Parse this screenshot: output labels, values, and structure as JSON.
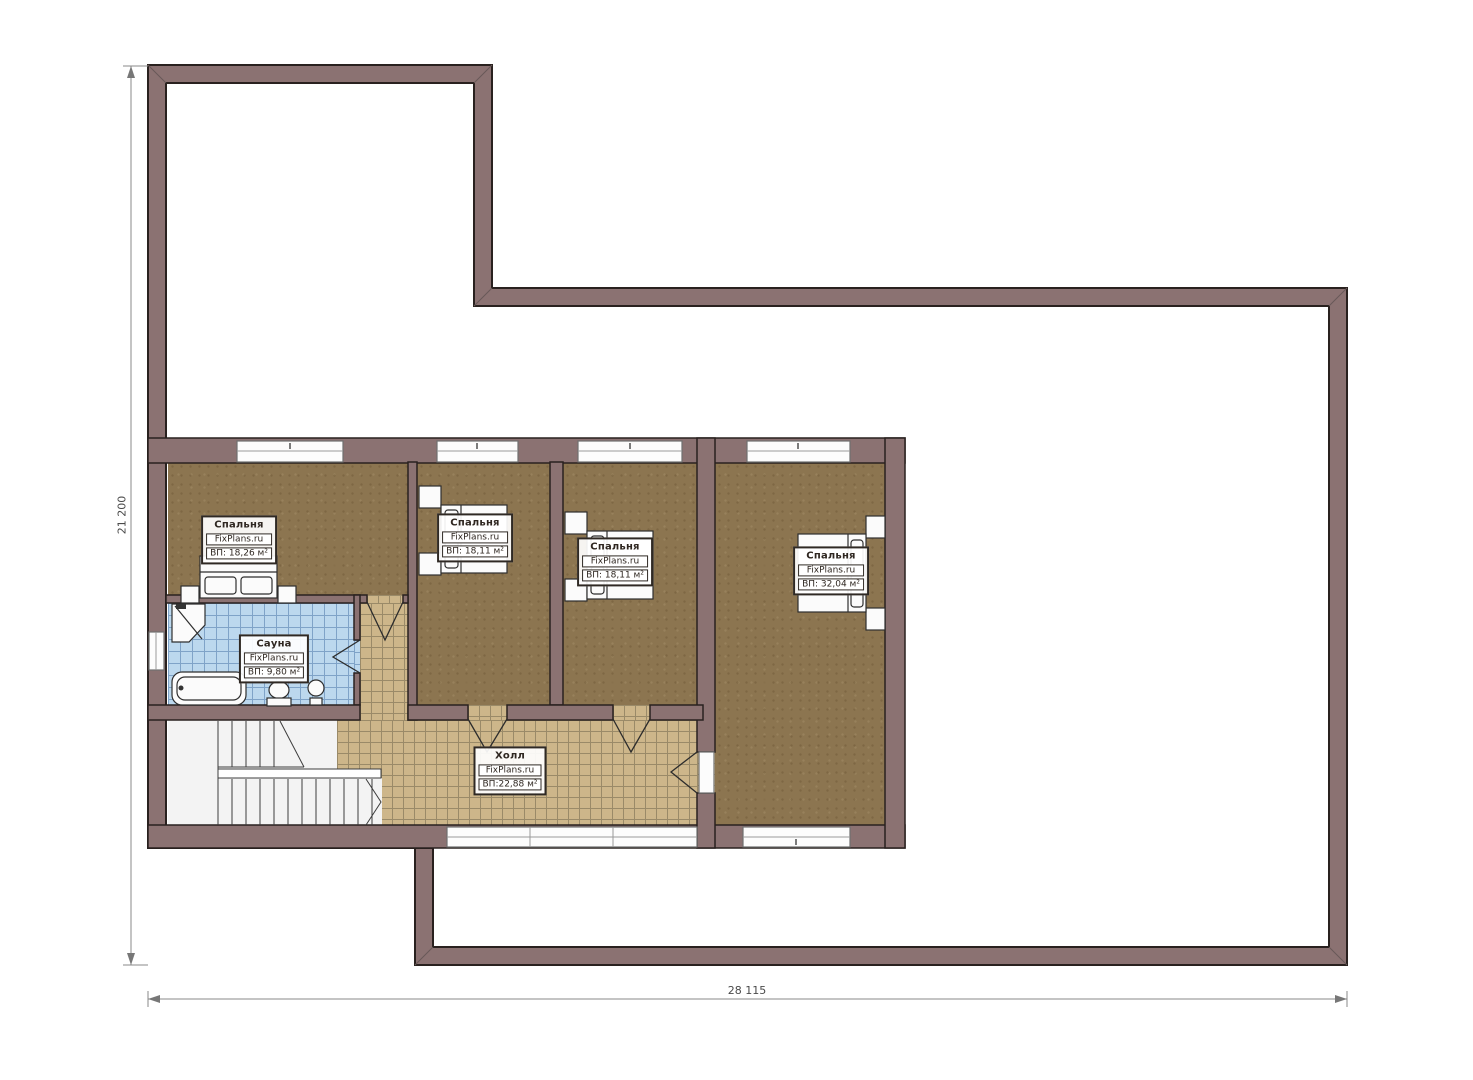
{
  "watermark": "FixPlans.ru",
  "rooms": [
    {
      "id": "bedroom-1",
      "name": "Спальня",
      "watermark": "FixPlans.ru",
      "area": "ВП: 18,26 м²"
    },
    {
      "id": "bedroom-2",
      "name": "Спальня",
      "watermark": "FixPlans.ru",
      "area": "ВП: 18,11 м²"
    },
    {
      "id": "bedroom-3",
      "name": "Спальня",
      "watermark": "FixPlans.ru",
      "area": "ВП: 18,11 м²"
    },
    {
      "id": "bedroom-4",
      "name": "Спальня",
      "watermark": "FixPlans.ru",
      "area": "ВП: 32,04 м²"
    },
    {
      "id": "sauna",
      "name": "Сауна",
      "watermark": "FixPlans.ru",
      "area": "ВП: 9,80 м²"
    },
    {
      "id": "hall",
      "name": "Холл",
      "watermark": "FixPlans.ru",
      "area": "ВП:22,88 м²"
    }
  ],
  "dimensions": {
    "left_vertical": "21 200",
    "bottom_horizontal": "28 115"
  },
  "colors": {
    "wall": "#8b7272",
    "wall_edge": "#29211f",
    "bedroom_floor": "#8c7550",
    "hall_tile": "#cdb68a",
    "sauna_tile": "#bcd8ee",
    "stairs": "#f3f3f3",
    "background": "#ffffff"
  }
}
